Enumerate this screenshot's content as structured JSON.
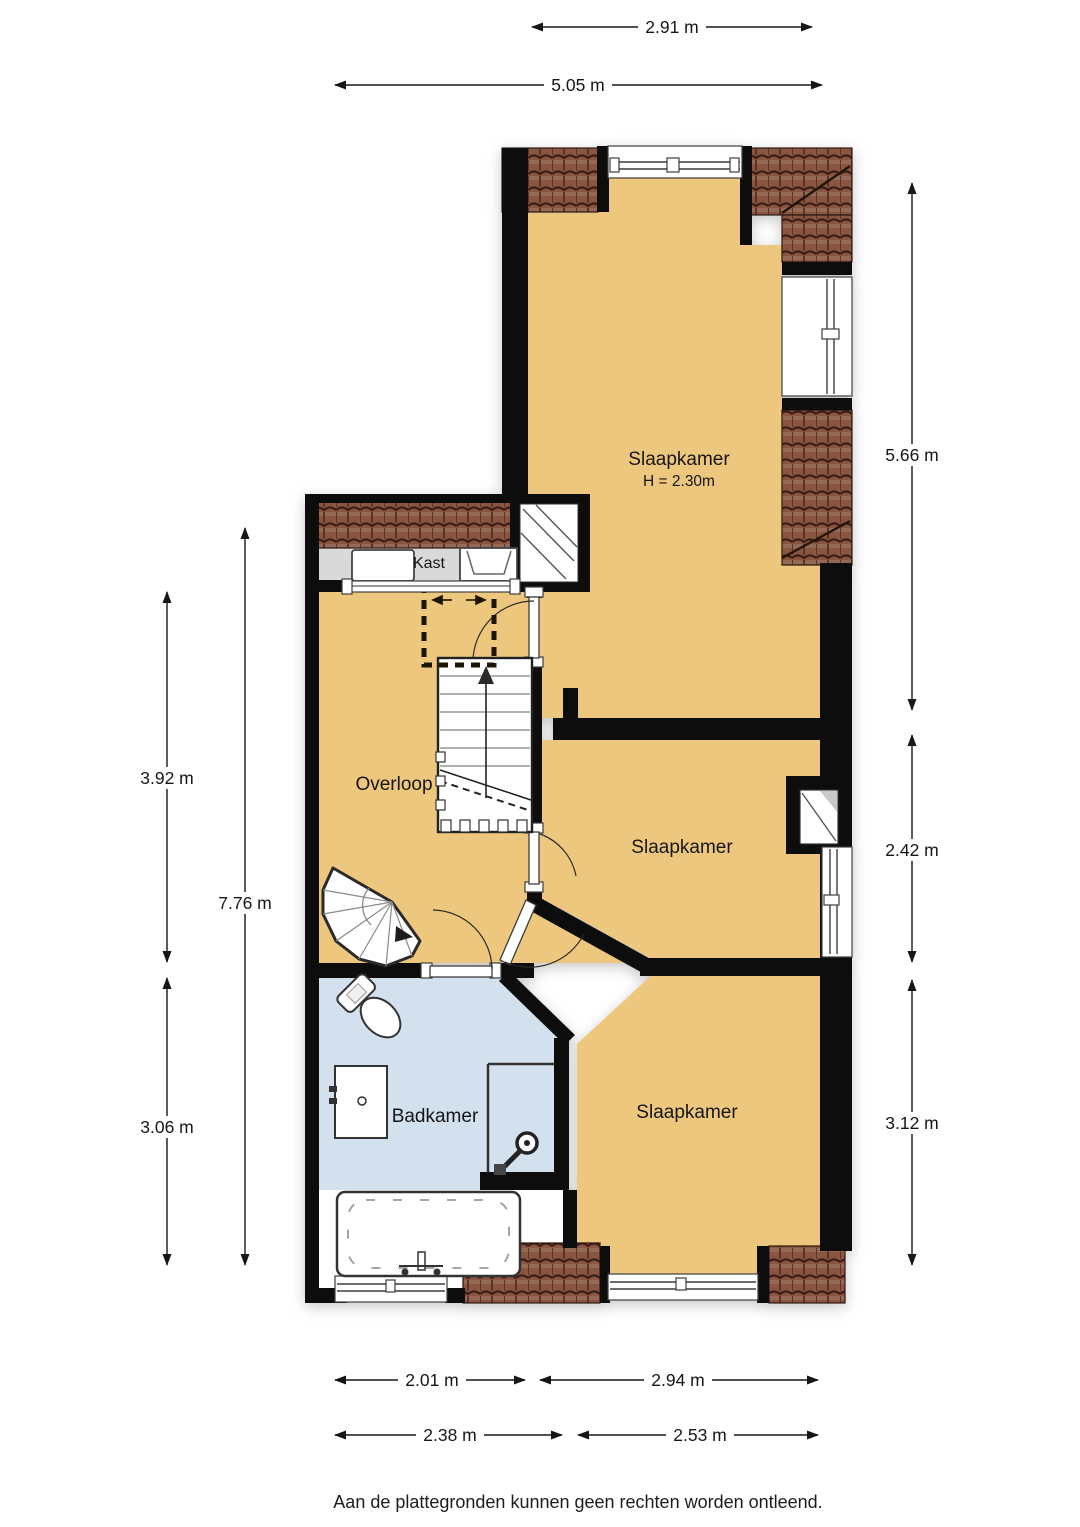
{
  "floorplan": {
    "rooms": {
      "bedroom_top": {
        "label": "Slaapkamer",
        "height_note": "H = 2.30m"
      },
      "closet": {
        "label": "Kast"
      },
      "landing": {
        "label": "Overloop"
      },
      "bedroom_middle": {
        "label": "Slaapkamer"
      },
      "bathroom": {
        "label": "Badkamer"
      },
      "bedroom_bottom": {
        "label": "Slaapkamer"
      }
    },
    "dimensions": {
      "top_inner": "2.91 m",
      "top_outer": "5.05 m",
      "right_top": "5.66 m",
      "right_middle": "2.42 m",
      "right_bottom": "3.12 m",
      "left_inner_top": "3.92 m",
      "left_outer": "7.76 m",
      "left_inner_bottom": "3.06 m",
      "bottom_inner_left": "2.01 m",
      "bottom_inner_right": "2.94 m",
      "bottom_outer_left": "2.38 m",
      "bottom_outer_right": "2.53 m"
    },
    "disclaimer": "Aan de plattegronden kunnen geen rechten worden ontleend.",
    "colors": {
      "room_fill": "#eec77f",
      "bathroom_fill": "#d3e0ee",
      "closet_fill": "#d9d9d9",
      "wall": "#080808",
      "roof_tile_base": "#8a5743",
      "roof_tile_line": "#3a1d12"
    }
  }
}
